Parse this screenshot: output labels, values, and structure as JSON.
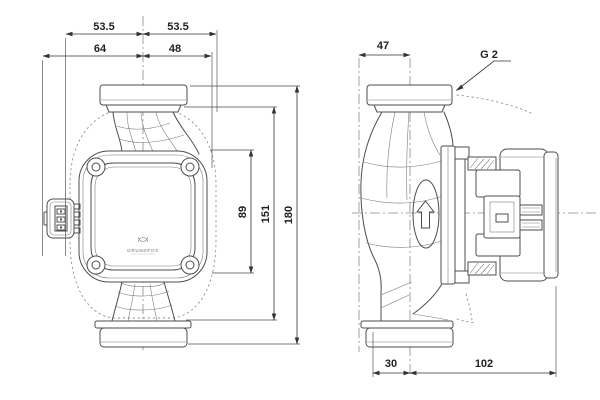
{
  "front_view": {
    "dim_top_left": "53.5",
    "dim_top_right": "53.5",
    "dim_mid_left": "64",
    "dim_mid_right": "48",
    "dim_height_head": "89",
    "dim_height_inner": "151",
    "dim_height_total": "180",
    "logo_text": "GRUNDFOS"
  },
  "side_view": {
    "dim_top_width": "47",
    "thread_callout": "G 2",
    "dim_bottom_front": "30",
    "dim_bottom_back": "102"
  },
  "colors": {
    "background": "#ffffff",
    "drawing_line": "#4d4d4d",
    "dimension_line": "#333333",
    "phantom_line": "#949494",
    "label_text": "#1f1f1f"
  }
}
